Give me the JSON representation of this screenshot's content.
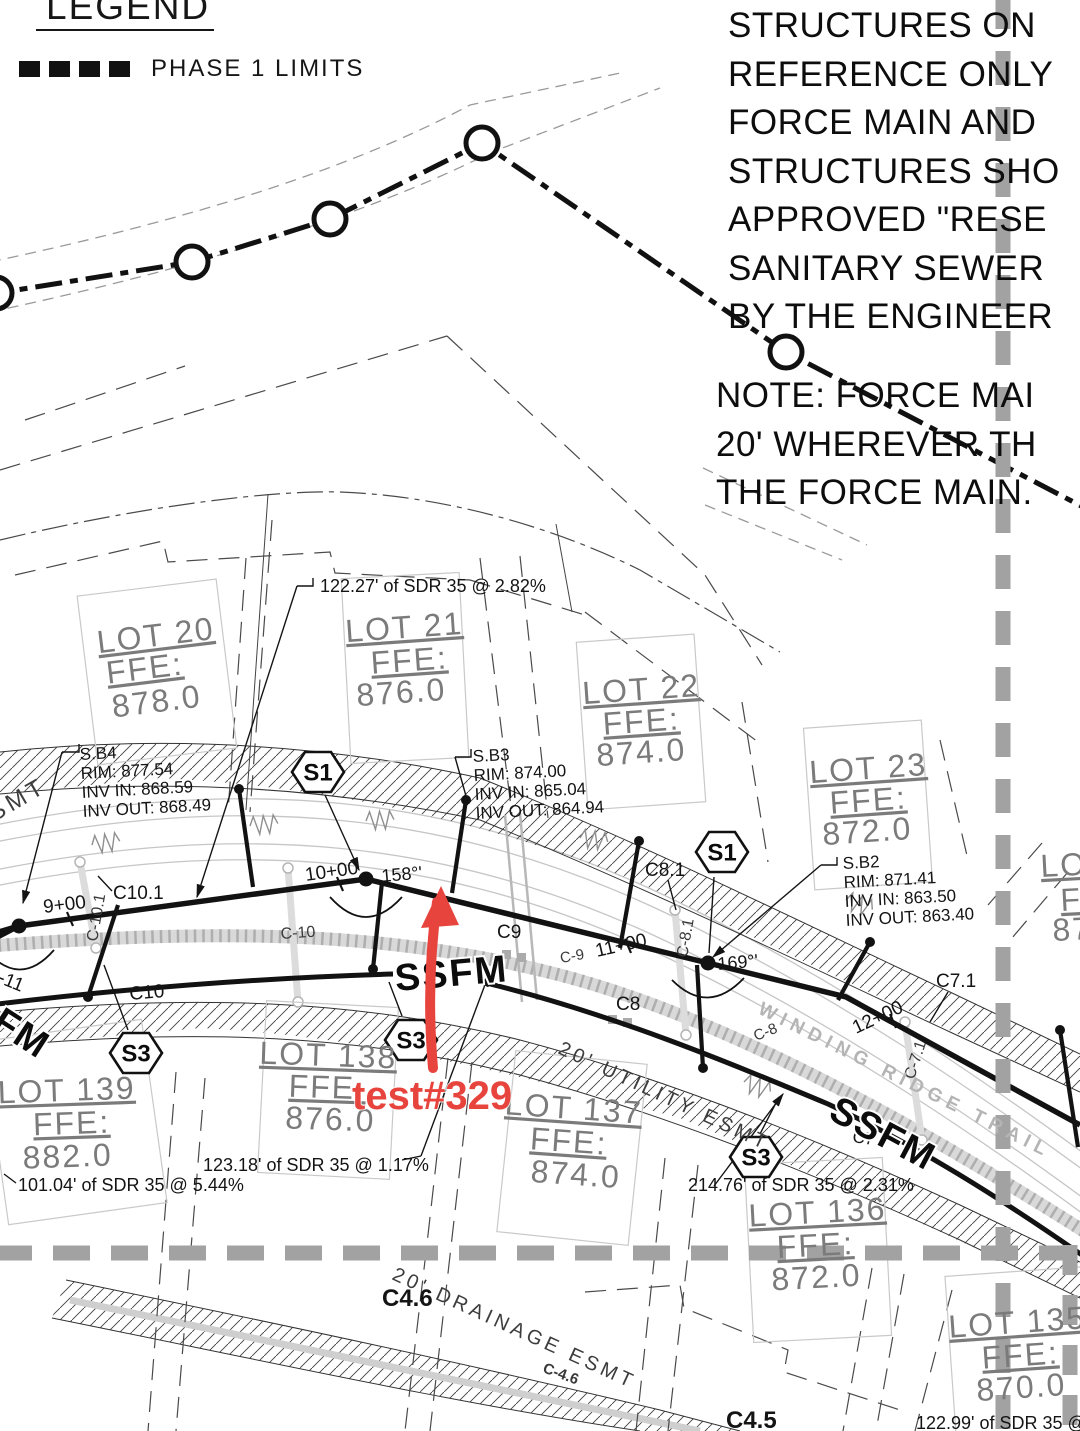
{
  "annotation": {
    "text": "test#329",
    "color": "#e8443e"
  },
  "legend": {
    "title": "LEGEND",
    "item": "PHASE 1 LIMITS"
  },
  "notes": {
    "lines": [
      "STRUCTURES ON",
      "REFERENCE ONLY",
      "FORCE MAIN AND",
      "STRUCTURES SHO",
      "APPROVED \"RESE",
      "SANITARY SEWER",
      "BY THE ENGINEER"
    ]
  },
  "note2": {
    "lines": [
      "NOTE: FORCE MAI",
      "20' WHEREVER TH",
      "THE FORCE MAIN."
    ]
  },
  "colors": {
    "ink": "#161616",
    "phase_gray": "#a2a2a2",
    "lot_text": "#7b7b7b",
    "trail_gray": "#c6c6c6"
  },
  "badges": [
    {
      "n": "structure-badge-s1-a",
      "t": "S1",
      "x": 318,
      "y": 772
    },
    {
      "n": "structure-badge-s1-b",
      "t": "S1",
      "x": 722,
      "y": 852
    },
    {
      "n": "structure-badge-s3-a",
      "t": "S3",
      "x": 136,
      "y": 1053
    },
    {
      "n": "structure-badge-s3-b",
      "t": "S3",
      "x": 411,
      "y": 1040
    },
    {
      "n": "structure-badge-s3-c",
      "t": "S3",
      "x": 756,
      "y": 1157
    }
  ],
  "labels": [
    {
      "n": "esmt-label-smt",
      "t": "SMT",
      "x": -6,
      "y": 822,
      "r": -30,
      "s": 24,
      "c": "esmt"
    },
    {
      "n": "callout-sb4-title",
      "t": "S.B4",
      "x": 80,
      "y": 760,
      "r": -3,
      "s": 17,
      "c": "tech"
    },
    {
      "n": "callout-sb4-rim",
      "t": "RIM: 877.54",
      "x": 81,
      "y": 779,
      "r": -3,
      "s": 17,
      "c": "tech"
    },
    {
      "n": "callout-sb4-inv-in",
      "t": "INV IN: 868.59",
      "x": 82,
      "y": 798,
      "r": -3,
      "s": 17,
      "c": "tech"
    },
    {
      "n": "callout-sb4-inv-out",
      "t": "INV OUT: 868.49",
      "x": 83,
      "y": 817,
      "r": -3,
      "s": 17,
      "c": "tech"
    },
    {
      "n": "callout-sb3-title",
      "t": "S.B3",
      "x": 473,
      "y": 762,
      "r": -3,
      "s": 17,
      "c": "tech"
    },
    {
      "n": "callout-sb3-rim",
      "t": "RIM: 874.00",
      "x": 474,
      "y": 781,
      "r": -3,
      "s": 17,
      "c": "tech"
    },
    {
      "n": "callout-sb3-inv-in",
      "t": "INV IN: 865.04",
      "x": 475,
      "y": 800,
      "r": -3,
      "s": 17,
      "c": "tech"
    },
    {
      "n": "callout-sb3-inv-out",
      "t": "INV OUT: 864.94",
      "x": 476,
      "y": 819,
      "r": -3,
      "s": 17,
      "c": "tech"
    },
    {
      "n": "callout-sb2-title",
      "t": "S.B2",
      "x": 843,
      "y": 869,
      "r": -3,
      "s": 17,
      "c": "tech"
    },
    {
      "n": "callout-sb2-rim",
      "t": "RIM: 871.41",
      "x": 844,
      "y": 888,
      "r": -3,
      "s": 17,
      "c": "tech"
    },
    {
      "n": "callout-sb2-inv-in",
      "t": "INV IN: 863.50",
      "x": 845,
      "y": 907,
      "r": -3,
      "s": 17,
      "c": "tech"
    },
    {
      "n": "callout-sb2-inv-out",
      "t": "INV OUT: 863.40",
      "x": 846,
      "y": 926,
      "r": -3,
      "s": 17,
      "c": "tech"
    },
    {
      "n": "pipe-label-122",
      "t": "122.27'  of  SDR  35  @  2.82%",
      "x": 320,
      "y": 592,
      "r": 0,
      "s": 18,
      "c": "pipe"
    },
    {
      "n": "pipe-label-123",
      "t": "123.18'  of  SDR  35  @  1.17%",
      "x": 203,
      "y": 1171,
      "r": 0,
      "s": 18,
      "c": "pipe"
    },
    {
      "n": "pipe-label-101",
      "t": "101.04'  of  SDR  35  @  5.44%",
      "x": 18,
      "y": 1191,
      "r": 0,
      "s": 18,
      "c": "pipe"
    },
    {
      "n": "pipe-label-214",
      "t": "214.76'  of  SDR  35  @  2.31%",
      "x": 688,
      "y": 1191,
      "r": 0,
      "s": 18,
      "c": "pipe"
    },
    {
      "n": "pipe-label-12299",
      "t": "122.99'  of  SDR  35  @  7",
      "x": 916,
      "y": 1429,
      "r": 0,
      "s": 18,
      "c": "pipe"
    },
    {
      "n": "station-9-00",
      "t": "9+00",
      "x": 44,
      "y": 913,
      "r": -7,
      "s": 19,
      "c": "sta"
    },
    {
      "n": "station-10-00",
      "t": "10+00",
      "x": 306,
      "y": 881,
      "r": -8,
      "s": 19,
      "c": "sta"
    },
    {
      "n": "station-11-00",
      "t": "11+00",
      "x": 597,
      "y": 957,
      "r": -13,
      "s": 19,
      "c": "sta"
    },
    {
      "n": "station-12-00",
      "t": "12+00",
      "x": 856,
      "y": 1034,
      "r": -25,
      "s": 19,
      "c": "sta"
    },
    {
      "n": "deflection-angle-158",
      "t": "158°'",
      "x": 382,
      "y": 882,
      "r": -5,
      "s": 18,
      "c": "angle"
    },
    {
      "n": "deflection-angle-169",
      "t": "169°'",
      "x": 718,
      "y": 970,
      "r": -5,
      "s": 18,
      "c": "angle"
    },
    {
      "n": "curve-label-c10-1",
      "t": "C10.1",
      "x": 113,
      "y": 899,
      "r": 0,
      "s": 19,
      "c": "cxx"
    },
    {
      "n": "curve-label-c-10-1",
      "t": "C-10.1",
      "x": 97,
      "y": 942,
      "r": -80,
      "s": 16,
      "c": "csm"
    },
    {
      "n": "curve-label-c-11",
      "t": "C-11",
      "x": -16,
      "y": 977,
      "r": 22,
      "s": 19,
      "c": "cxx"
    },
    {
      "n": "curve-label-c10",
      "t": "C10",
      "x": 130,
      "y": 1000,
      "r": -5,
      "s": 19,
      "c": "cxx"
    },
    {
      "n": "curve-label-c-10",
      "t": "C-10",
      "x": 281,
      "y": 939,
      "r": -4,
      "s": 16,
      "c": "csm"
    },
    {
      "n": "curve-label-c9",
      "t": "C9",
      "x": 497,
      "y": 938,
      "r": 0,
      "s": 19,
      "c": "cxx"
    },
    {
      "n": "curve-label-c-9",
      "t": "C-9",
      "x": 561,
      "y": 963,
      "r": -10,
      "s": 15,
      "c": "csm"
    },
    {
      "n": "curve-label-c8-1",
      "t": "C8.1",
      "x": 645,
      "y": 876,
      "r": 0,
      "s": 19,
      "c": "cxx"
    },
    {
      "n": "curve-label-c-8-1",
      "t": "C-8.1",
      "x": 687,
      "y": 958,
      "r": -80,
      "s": 16,
      "c": "csm"
    },
    {
      "n": "curve-label-c8",
      "t": "C8",
      "x": 616,
      "y": 1010,
      "r": 0,
      "s": 19,
      "c": "cxx"
    },
    {
      "n": "curve-label-c-8",
      "t": "C-8",
      "x": 756,
      "y": 1041,
      "r": -22,
      "s": 15,
      "c": "csm"
    },
    {
      "n": "curve-label-c7-1",
      "t": "C7.1",
      "x": 936,
      "y": 987,
      "r": 0,
      "s": 19,
      "c": "cxx"
    },
    {
      "n": "curve-label-c-7-1",
      "t": "C-7.1",
      "x": 914,
      "y": 1080,
      "r": -72,
      "s": 16,
      "c": "csm"
    },
    {
      "n": "curve-label-c7",
      "t": "C7",
      "x": 852,
      "y": 1142,
      "r": 8,
      "s": 17,
      "c": "cxx"
    },
    {
      "n": "curve-label-c4-6",
      "t": "C4.6",
      "x": 382,
      "y": 1306,
      "r": 0,
      "s": 24,
      "c": "cxx",
      "w": 600
    },
    {
      "n": "curve-label-c-4-6",
      "t": "C-4.6",
      "x": 542,
      "y": 1372,
      "r": 20,
      "s": 15,
      "c": "csm",
      "w": 600
    },
    {
      "n": "curve-label-c4-5",
      "t": "C4.5",
      "x": 726,
      "y": 1428,
      "r": 0,
      "s": 24,
      "c": "cxx",
      "w": 600
    },
    {
      "n": "ssfm-label-left",
      "t": "SSFM",
      "x": -56,
      "y": 998,
      "r": 33,
      "s": 38,
      "c": "ssfm"
    },
    {
      "n": "ssfm-label-center",
      "t": "SSFM",
      "x": 396,
      "y": 991,
      "r": -5,
      "s": 38,
      "c": "ssfm"
    },
    {
      "n": "ssfm-label-right",
      "t": "SSFM",
      "x": 827,
      "y": 1118,
      "r": 28,
      "s": 38,
      "c": "ssfm"
    },
    {
      "n": "street-label-winding-ridge-trail",
      "t": "WINDING RIDGE TRAIL",
      "x": 757,
      "y": 1013,
      "r": 26.5,
      "s": 19,
      "c": "street"
    },
    {
      "n": "esmt-label-utility",
      "t": "20' UTILITY ESMT",
      "x": 557,
      "y": 1053,
      "r": 25,
      "s": 20,
      "c": "esmt"
    },
    {
      "n": "esmt-label-drainage",
      "t": "20' DRAINAGE ESMT",
      "x": 391,
      "y": 1279,
      "r": 24.5,
      "s": 20,
      "c": "esmt"
    },
    {
      "n": "lot-20-name",
      "t": "LOT 20",
      "x": 157,
      "y": 646,
      "r": -7,
      "s": 32,
      "c": "lot",
      "a": "middle",
      "u": true
    },
    {
      "n": "lot-20-ffe-label",
      "t": "FFE:",
      "x": 146,
      "y": 679,
      "r": -7,
      "s": 32,
      "c": "lot",
      "a": "middle",
      "u": true
    },
    {
      "n": "lot-20-ffe-value",
      "t": "878.0",
      "x": 158,
      "y": 712,
      "r": -7,
      "s": 32,
      "c": "lot",
      "a": "middle"
    },
    {
      "n": "lot-21-name",
      "t": "LOT 21",
      "x": 405,
      "y": 638,
      "r": -4,
      "s": 32,
      "c": "lot",
      "a": "middle",
      "u": true
    },
    {
      "n": "lot-21-ffe-label",
      "t": "FFE:",
      "x": 410,
      "y": 671,
      "r": -4,
      "s": 32,
      "c": "lot",
      "a": "middle",
      "u": true
    },
    {
      "n": "lot-21-ffe-value",
      "t": "876.0",
      "x": 402,
      "y": 703,
      "r": -4,
      "s": 32,
      "c": "lot",
      "a": "middle"
    },
    {
      "n": "lot-22-name",
      "t": "LOT 22",
      "x": 642,
      "y": 700,
      "r": -4,
      "s": 32,
      "c": "lot",
      "a": "middle",
      "u": true
    },
    {
      "n": "lot-22-ffe-label",
      "t": "FFE:",
      "x": 642,
      "y": 732,
      "r": -4,
      "s": 32,
      "c": "lot",
      "a": "middle",
      "u": true
    },
    {
      "n": "lot-22-ffe-value",
      "t": "874.0",
      "x": 642,
      "y": 763,
      "r": -4,
      "s": 32,
      "c": "lot",
      "a": "middle"
    },
    {
      "n": "lot-23-name",
      "t": "LOT 23",
      "x": 869,
      "y": 779,
      "r": -4,
      "s": 32,
      "c": "lot",
      "a": "middle",
      "u": true
    },
    {
      "n": "lot-23-ffe-label",
      "t": "FFE:",
      "x": 869,
      "y": 811,
      "r": -4,
      "s": 32,
      "c": "lot",
      "a": "middle",
      "u": true
    },
    {
      "n": "lot-23-ffe-value",
      "t": "872.0",
      "x": 868,
      "y": 842,
      "r": -4,
      "s": 32,
      "c": "lot",
      "a": "middle"
    },
    {
      "n": "lot-139-name",
      "t": "LOT 139",
      "x": 67,
      "y": 1101,
      "r": -2,
      "s": 32,
      "c": "lot",
      "a": "middle",
      "u": true
    },
    {
      "n": "lot-139-ffe-label",
      "t": "FFE:",
      "x": 72,
      "y": 1134,
      "r": -2,
      "s": 32,
      "c": "lot",
      "a": "middle",
      "u": true
    },
    {
      "n": "lot-139-ffe-value",
      "t": "882.0",
      "x": 68,
      "y": 1167,
      "r": -2,
      "s": 32,
      "c": "lot",
      "a": "middle"
    },
    {
      "n": "lot-138-name",
      "t": "LOT 138",
      "x": 328,
      "y": 1066,
      "r": 2,
      "s": 32,
      "c": "lot",
      "a": "middle",
      "u": true
    },
    {
      "n": "lot-138-ffe-label",
      "t": "FFE:",
      "x": 327,
      "y": 1098,
      "r": 2,
      "s": 32,
      "c": "lot",
      "a": "middle",
      "u": true
    },
    {
      "n": "lot-138-ffe-value",
      "t": "876.0",
      "x": 330,
      "y": 1130,
      "r": 2,
      "s": 32,
      "c": "lot",
      "a": "middle"
    },
    {
      "n": "lot-137-name",
      "t": "LOT 137",
      "x": 573,
      "y": 1119,
      "r": 4,
      "s": 32,
      "c": "lot",
      "a": "middle",
      "u": true
    },
    {
      "n": "lot-137-ffe-label",
      "t": "FFE:",
      "x": 568,
      "y": 1152,
      "r": 4,
      "s": 32,
      "c": "lot",
      "a": "middle",
      "u": true
    },
    {
      "n": "lot-137-ffe-value",
      "t": "874.0",
      "x": 575,
      "y": 1185,
      "r": 4,
      "s": 32,
      "c": "lot",
      "a": "middle"
    },
    {
      "n": "lot-136-name",
      "t": "LOT 136",
      "x": 818,
      "y": 1223,
      "r": -3,
      "s": 32,
      "c": "lot",
      "a": "middle",
      "u": true
    },
    {
      "n": "lot-136-ffe-label",
      "t": "FFE:",
      "x": 816,
      "y": 1256,
      "r": -3,
      "s": 32,
      "c": "lot",
      "a": "middle",
      "u": true
    },
    {
      "n": "lot-136-ffe-value",
      "t": "872.0",
      "x": 817,
      "y": 1288,
      "r": -3,
      "s": 32,
      "c": "lot",
      "a": "middle"
    },
    {
      "n": "lot-135-name",
      "t": "LOT 135",
      "x": 1018,
      "y": 1333,
      "r": -4,
      "s": 32,
      "c": "lot",
      "a": "middle",
      "u": true
    },
    {
      "n": "lot-135-ffe-label",
      "t": "FFE:",
      "x": 1021,
      "y": 1366,
      "r": -4,
      "s": 32,
      "c": "lot",
      "a": "middle",
      "u": true
    },
    {
      "n": "lot-135-ffe-value",
      "t": "870.0",
      "x": 1022,
      "y": 1398,
      "r": -4,
      "s": 32,
      "c": "lot",
      "a": "middle"
    },
    {
      "n": "lot-edge-name",
      "t": "LOT",
      "x": 1041,
      "y": 877,
      "r": -3,
      "s": 32,
      "c": "lot",
      "u": true
    },
    {
      "n": "lot-edge-ffe-label",
      "t": "FF",
      "x": 1061,
      "y": 911,
      "r": -3,
      "s": 32,
      "c": "lot",
      "u": true
    },
    {
      "n": "lot-edge-ffe-value",
      "t": "87",
      "x": 1053,
      "y": 941,
      "r": -3,
      "s": 32,
      "c": "lot"
    },
    {
      "n": "annotation-test329",
      "t": "test#329",
      "x": 352,
      "y": 1109,
      "r": 0,
      "s": 40,
      "c": "red"
    }
  ]
}
